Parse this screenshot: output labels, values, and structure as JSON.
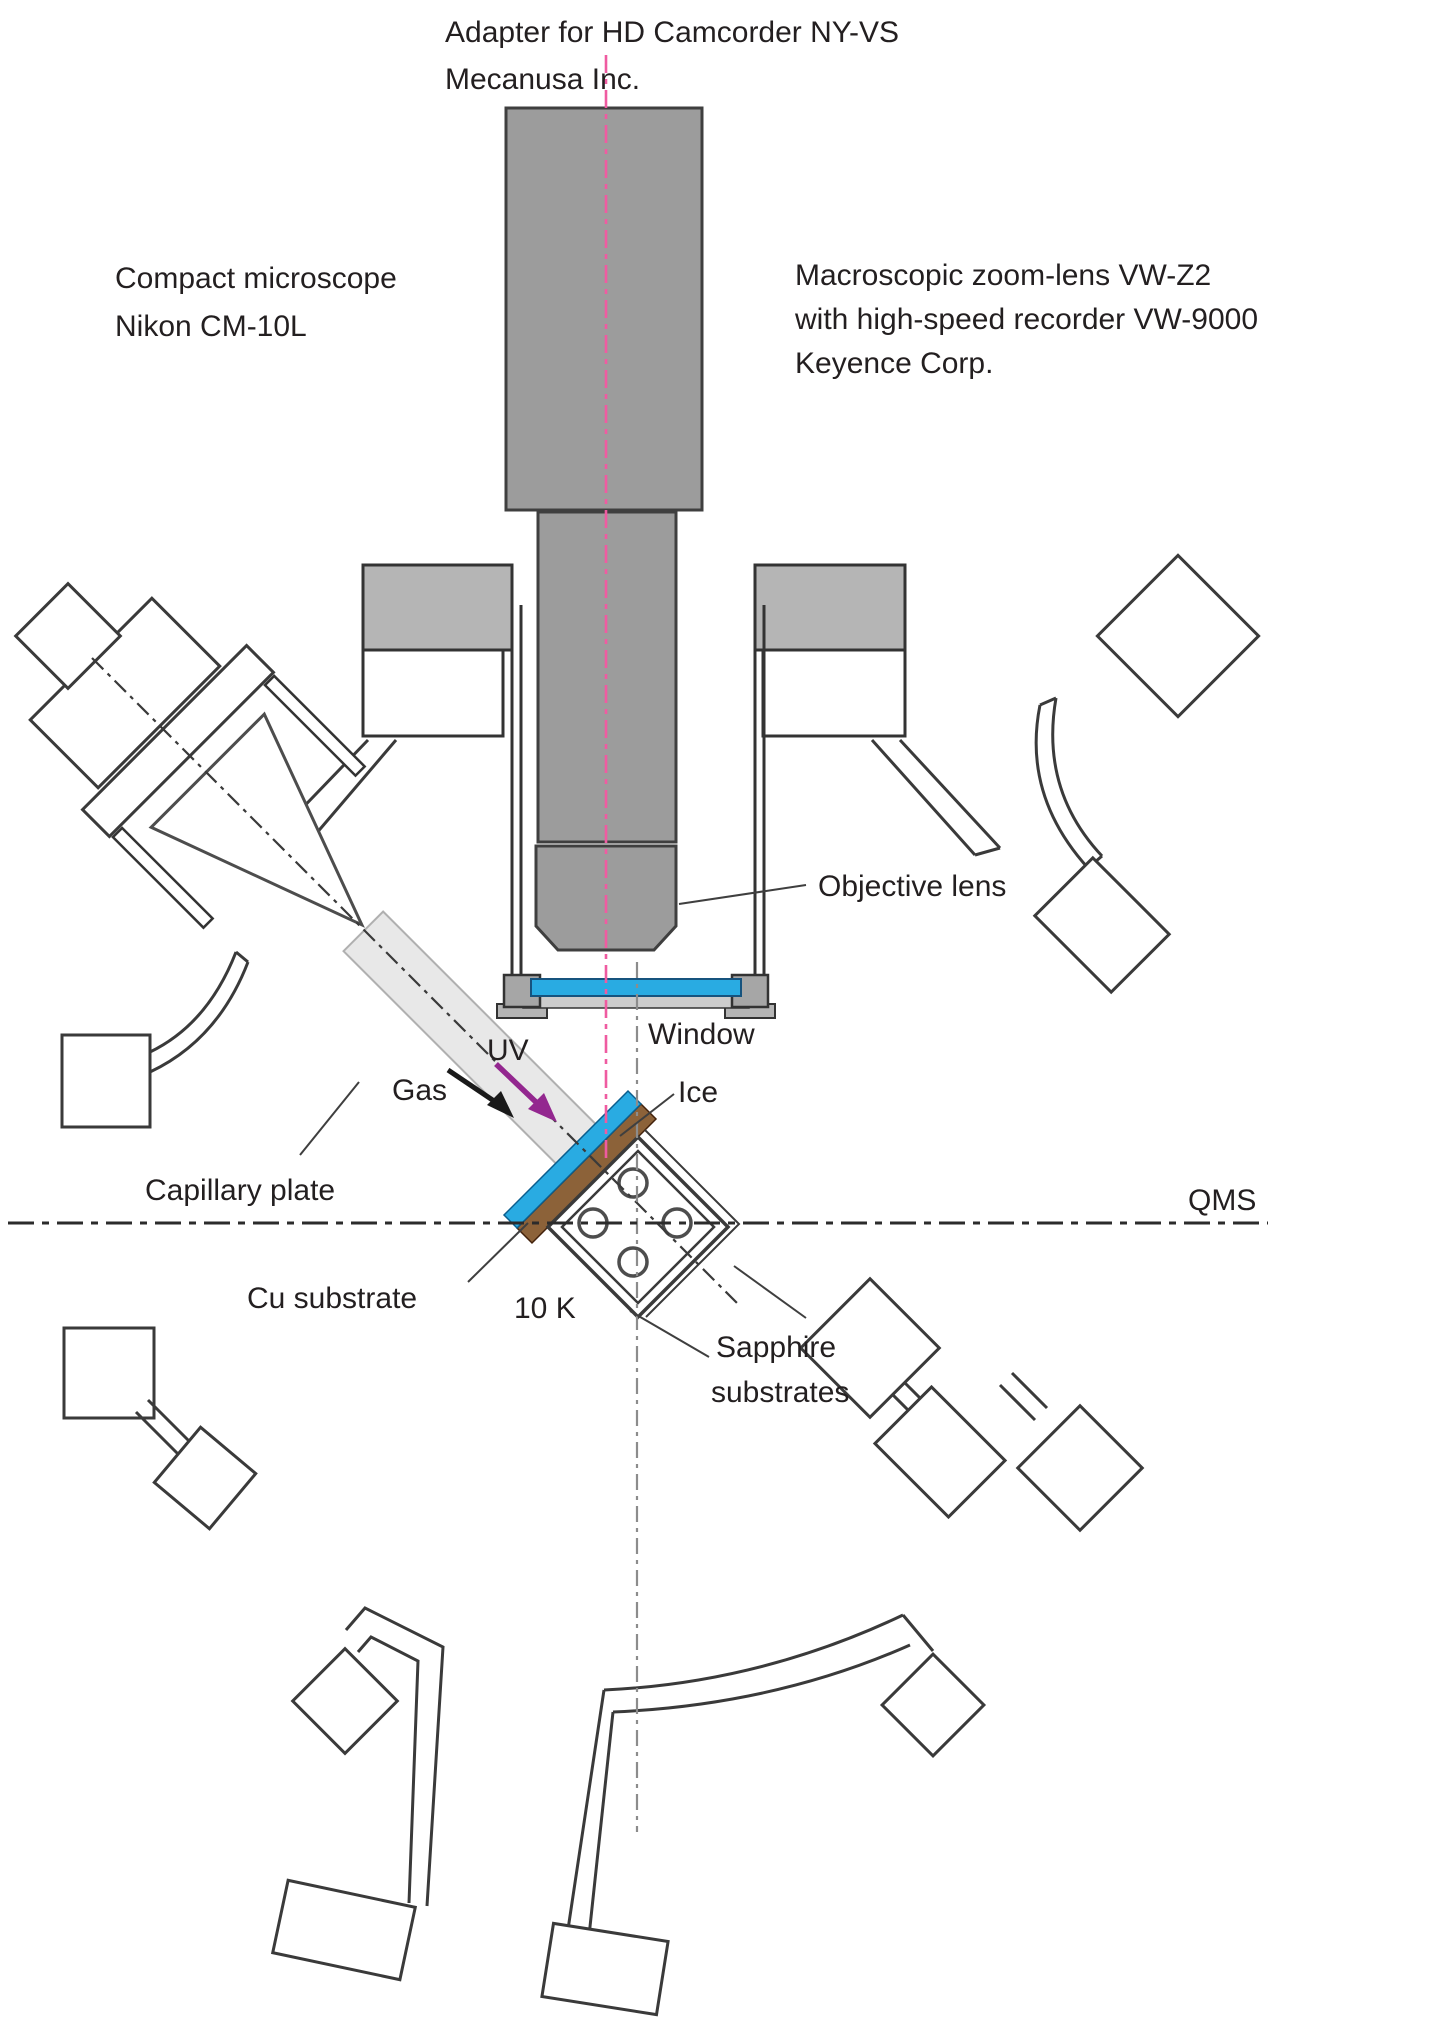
{
  "labels": {
    "adapter_line1": "Adapter for HD Camcorder NY-VS",
    "adapter_line2": "Mecanusa Inc.",
    "microscope_line1": "Compact microscope",
    "microscope_line2": "Nikon CM-10L",
    "zoomlens_line1": "Macroscopic zoom-lens VW-Z2",
    "zoomlens_line2": "with high-speed recorder VW-9000",
    "zoomlens_line3": "Keyence Corp.",
    "objective": "Objective lens",
    "window": "Window",
    "uv": "UV",
    "gas": "Gas",
    "ice": "Ice",
    "capillary": "Capillary plate",
    "qms": "QMS",
    "cu_substrate": "Cu substrate",
    "temperature": "10 K",
    "sapphire_line1": "Sapphire",
    "sapphire_line2": "substrates"
  },
  "colors": {
    "ice_blue": "#29ABE2",
    "cu_brown": "#8C6239",
    "uv_purple": "#93278F",
    "axis_pink": "#EF5BA1",
    "metal_gray": "#9C9C9C",
    "flange_gray": "#B5B5B5",
    "clamp_gray": "#A6A6A6",
    "beam_gray": "#E8E8E8",
    "line_dark": "#333333",
    "text": "#231F20"
  }
}
